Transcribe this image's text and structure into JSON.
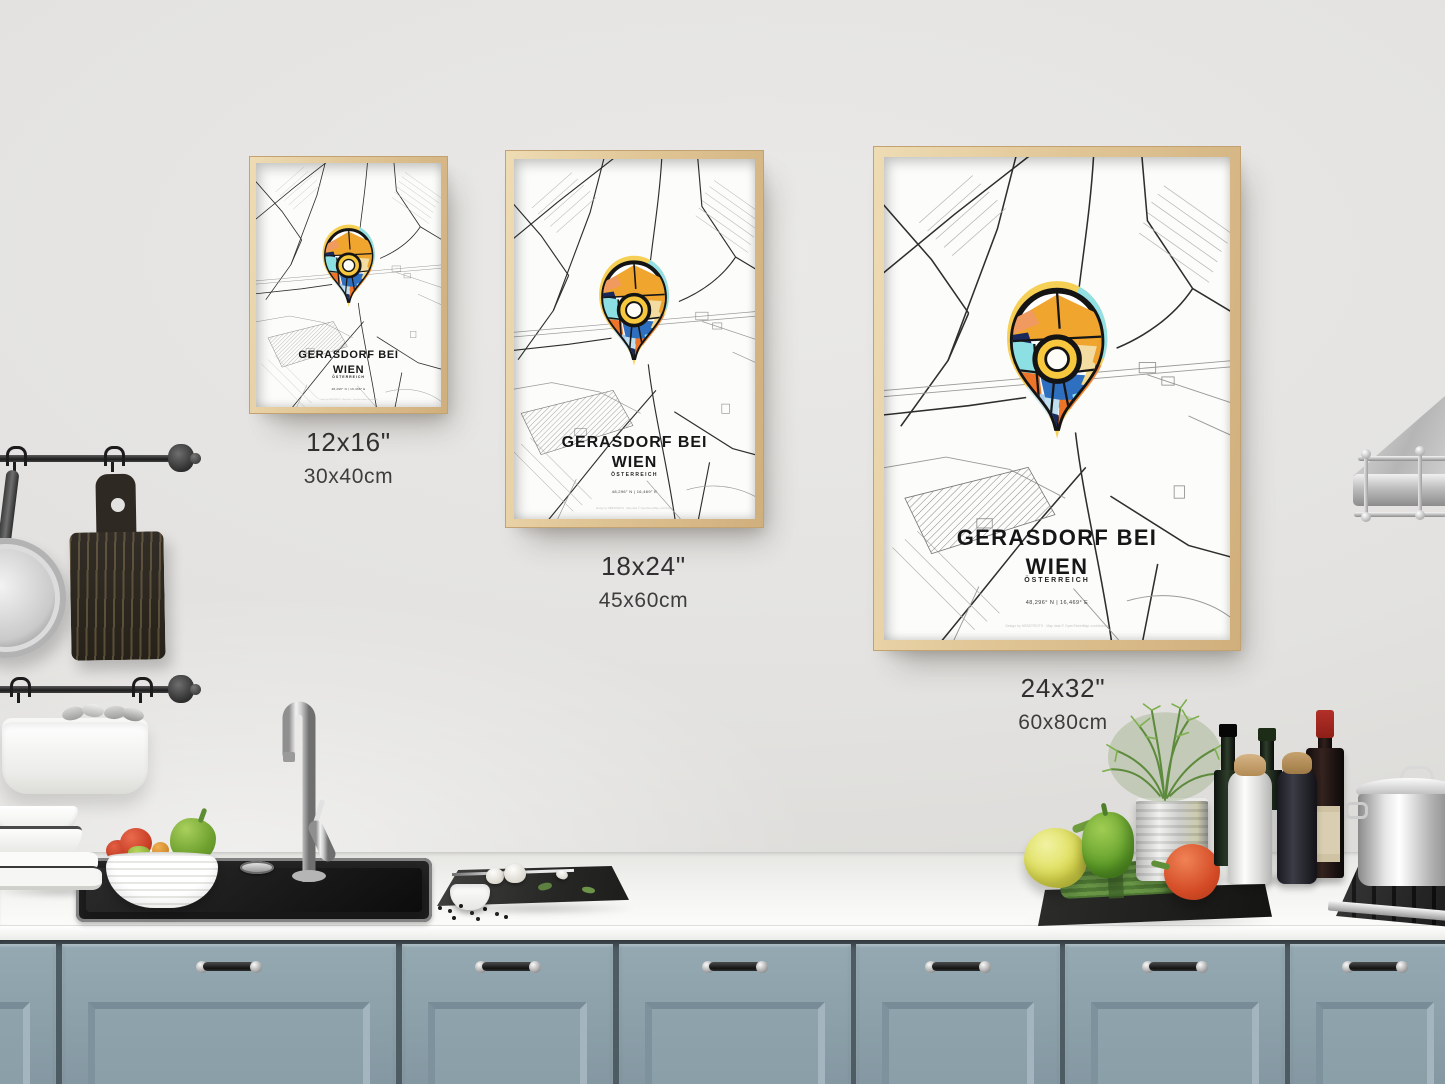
{
  "poster": {
    "title_line1": "GERASDORF BEI",
    "title_line2": "WIEN",
    "country": "ÖSTERREICH",
    "coordinates": "48,296° N | 16,469° E",
    "microprint": "Design by HEBSTREITS · Map data © OpenStreetMap contributors"
  },
  "sizes": [
    {
      "inches": "12x16\"",
      "cm": "30x40cm"
    },
    {
      "inches": "18x24\"",
      "cm": "45x60cm"
    },
    {
      "inches": "24x32\"",
      "cm": "60x80cm"
    }
  ],
  "colors": {
    "wall": "#e4e3e1",
    "cabinet": "#8fa3ad",
    "counter": "#f6f6f4",
    "frame_wood": "#e0c595",
    "pin_halo_yellow": "#f6cf55",
    "pin_halo_cyan": "#93e0e4",
    "pin_halo_orange": "#f08233",
    "pin_amber": "#f0a52f",
    "pin_orange": "#ee7428",
    "pin_cyan": "#8ce0e3",
    "pin_navy": "#19295c",
    "pin_blue": "#2f6fbf",
    "pin_cream": "#f2dca2"
  }
}
